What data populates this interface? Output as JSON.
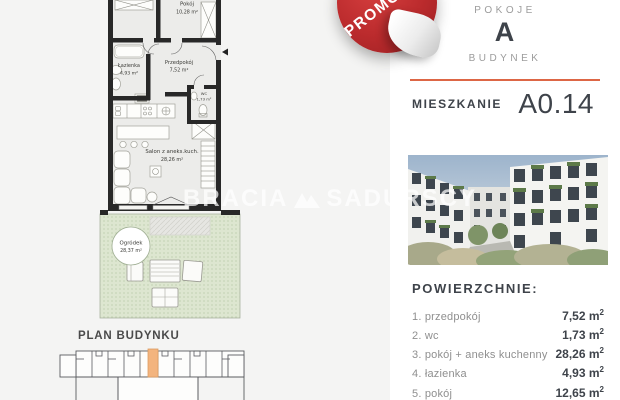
{
  "badge": {
    "label": "PROMOCJA",
    "color": "#bb2b2d"
  },
  "watermark": {
    "left": "BRACIA",
    "right": "SADURSCY"
  },
  "panel": {
    "rooms_label": "POKOJE",
    "building_value": "A",
    "building_label": "BUDYNEK",
    "apartment_label": "MIESZKANIE",
    "apartment_value": "A0.14",
    "accent_color": "#dd6645",
    "areas_heading": "POWIERZCHNIE:",
    "unit_base": "m",
    "unit_sup": "2",
    "areas": [
      {
        "name": "1. przedpokój",
        "value": "7,52"
      },
      {
        "name": "2. wc",
        "value": "1,73"
      },
      {
        "name": "3. pokój + aneks kuchenny",
        "value": "28,26"
      },
      {
        "name": "4. łazienka",
        "value": "4,93"
      },
      {
        "name": "5. pokój",
        "value": "12,65"
      }
    ]
  },
  "floor_plan": {
    "rooms": {
      "pokoj": {
        "name": "Pokój",
        "area": "10,28 m²"
      },
      "lazienka": {
        "name": "Łazienka",
        "area": "4,93 m²"
      },
      "przedpokoj": {
        "name": "Przedpokój",
        "area": "7,52 m²"
      },
      "wc": {
        "name": "WC",
        "area": "1,73 m²"
      },
      "salon": {
        "name": "Salon z aneks.kuch.",
        "area": "28,26 m²"
      },
      "ogrodek": {
        "name": "Ogródek",
        "area": "28,37 m²"
      }
    }
  },
  "building_plan": {
    "title": "PLAN BUDYNKU",
    "highlight_color": "#f3b47e"
  }
}
